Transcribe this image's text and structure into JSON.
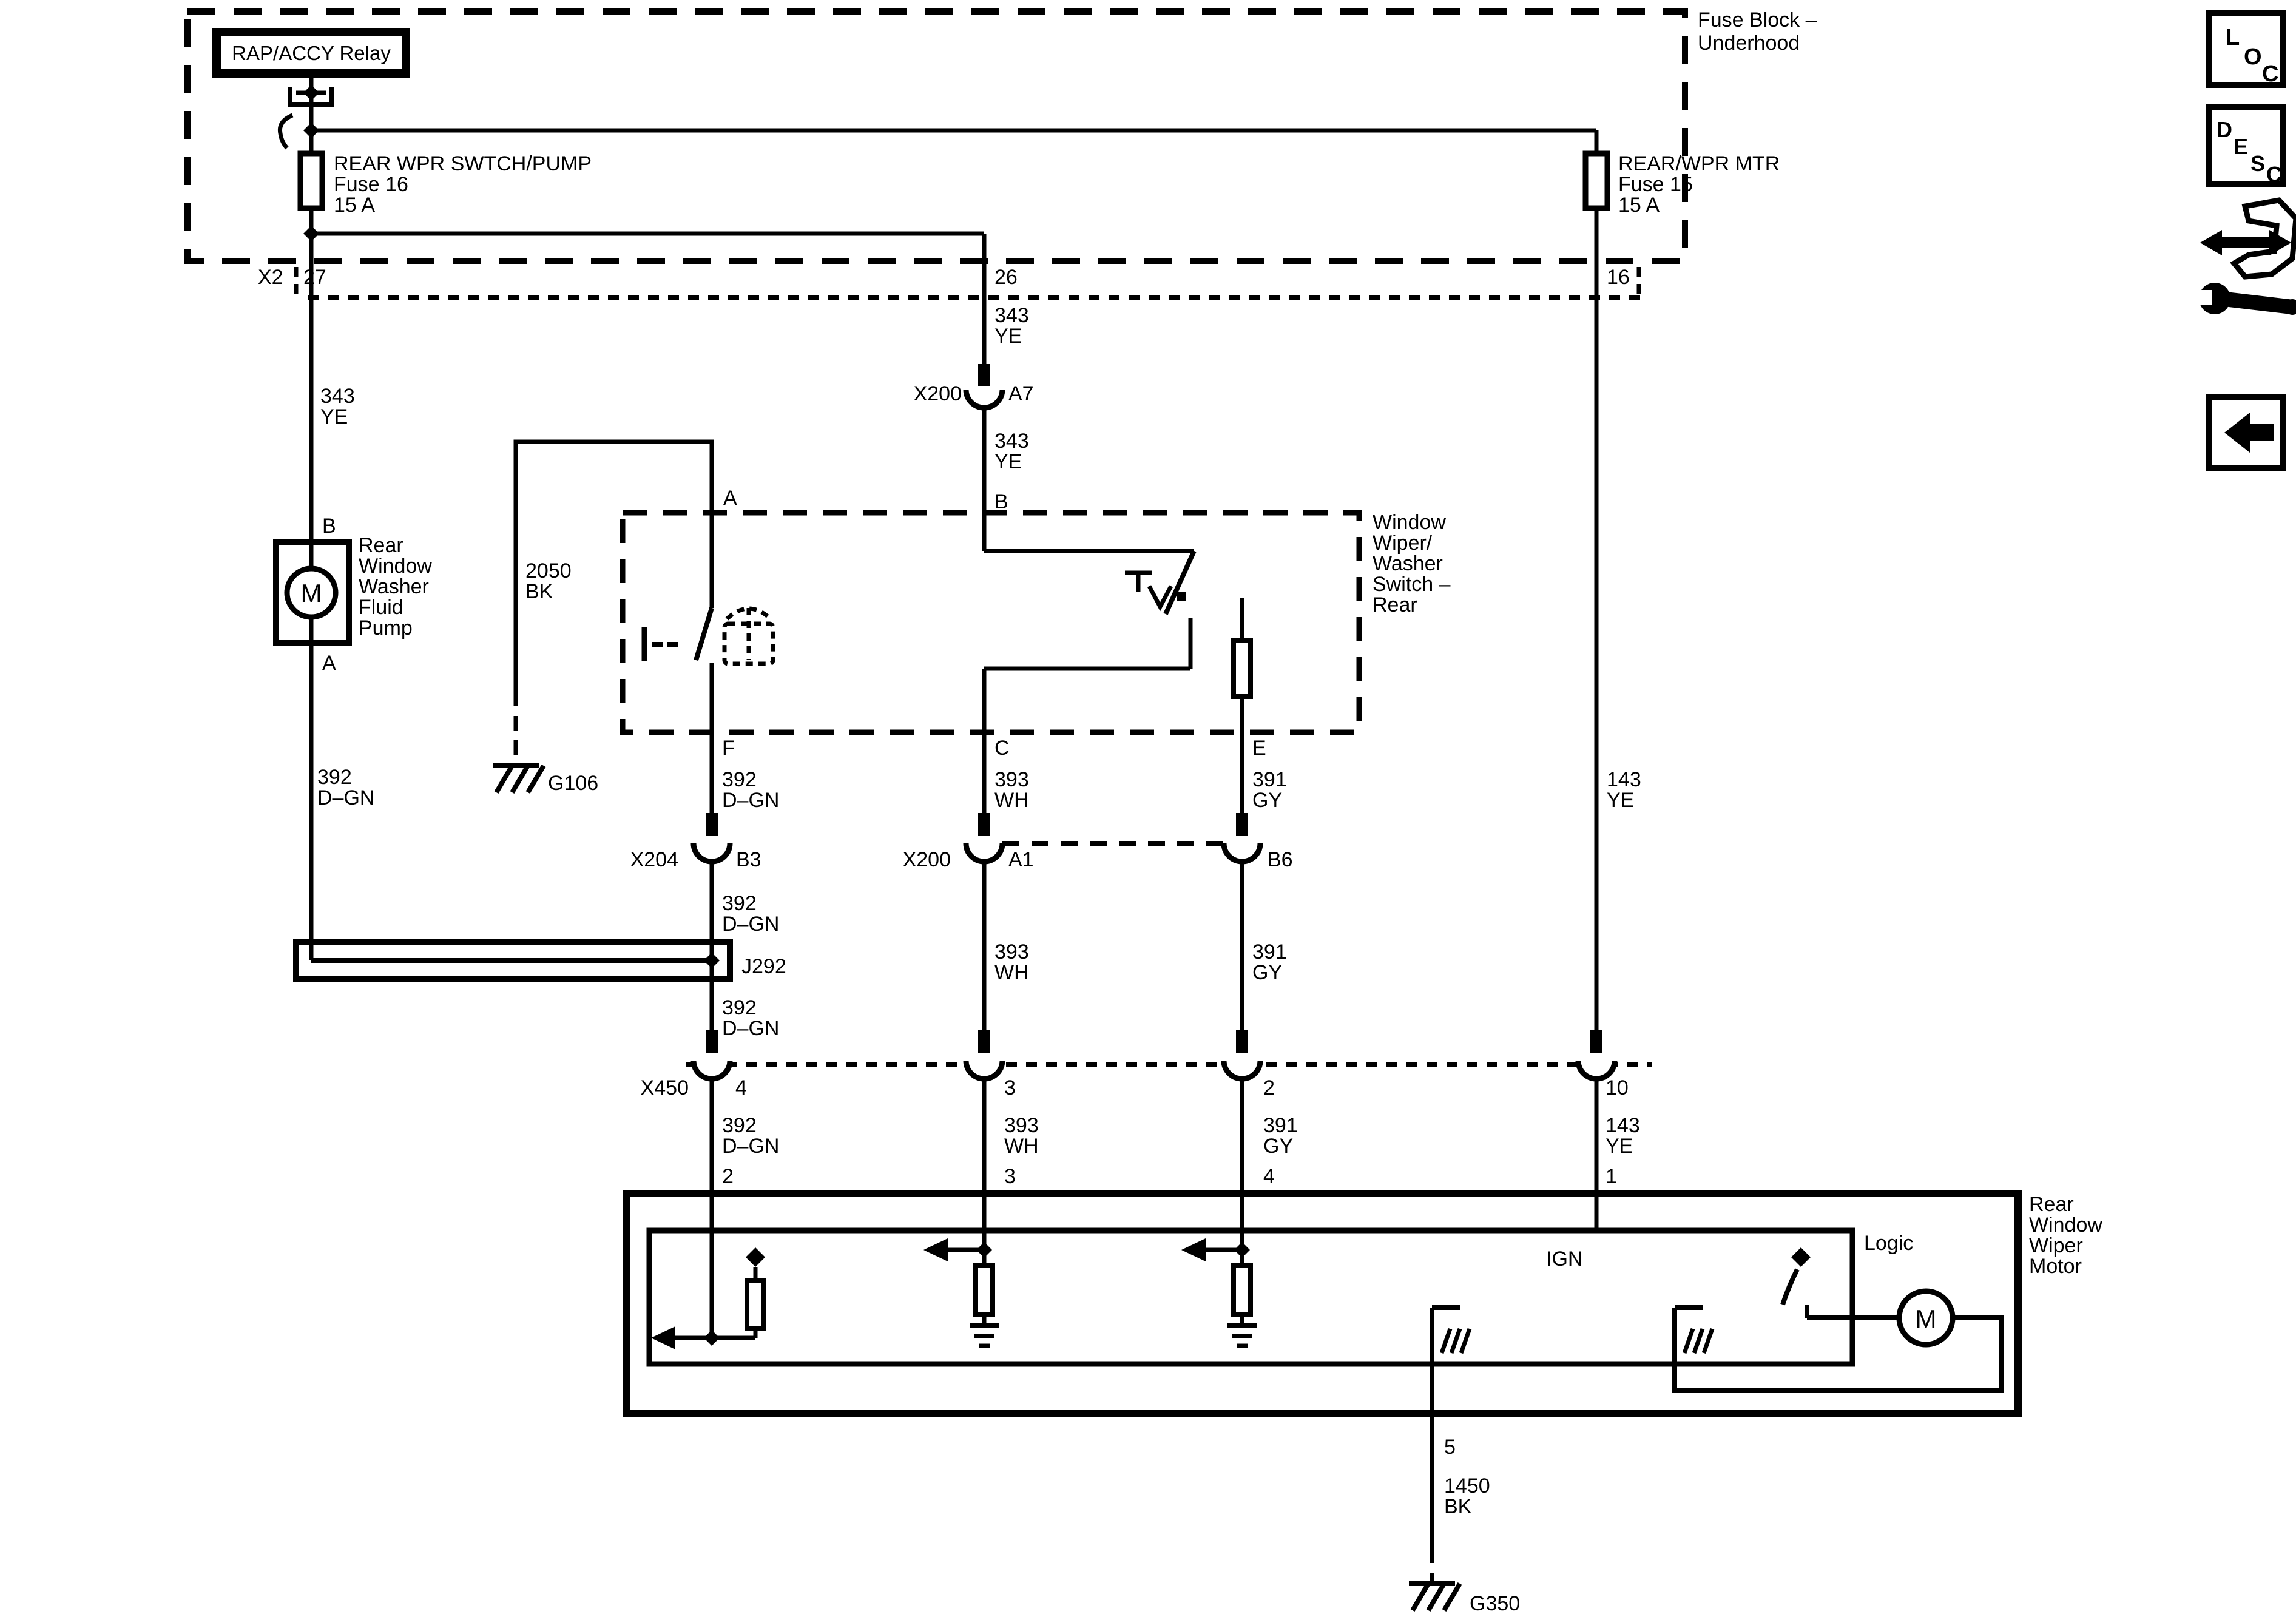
{
  "colors": {
    "ink": "#000000",
    "paper": "#ffffff"
  },
  "icons": [
    "loc-box-icon",
    "desc-box-icon",
    "pan-wrench-icon",
    "back-arrow-icon",
    "ground-chassis-icon",
    "motor-icon",
    "fuse-icon",
    "connector-icon"
  ],
  "t": {
    "relay": "RAP/ACCY Relay",
    "fuse_block_l1": "Fuse Block –",
    "fuse_block_l2": "Underhood",
    "fuse16_l1": "REAR WPR SWTCH/PUMP",
    "fuse16_l2": "Fuse 16",
    "fuse16_l3": "15 A",
    "fuse15_l1": "REAR/WPR MTR",
    "fuse15_l2": "Fuse 15",
    "fuse15_l3": "15 A",
    "x2": "X2",
    "pin27": "27",
    "pin26": "26",
    "pin16": "16",
    "left343": "343",
    "left343c": "YE",
    "mid343a": "343",
    "mid343ac": "YE",
    "x200a": "X200",
    "pinA7": "A7",
    "mid343b": "343",
    "mid343bc": "YE",
    "pinB_switch": "B",
    "pinA_switch": "A",
    "pinB_pump": "B",
    "pinA_pump": "A",
    "pump_l1": "Rear",
    "pump_l2": "Window",
    "pump_l3": "Washer",
    "pump_l4": "Fluid",
    "pump_l5": "Pump",
    "pump_m": "M",
    "c2050": "2050",
    "c2050c": "BK",
    "g106": "G106",
    "sw_l1": "Window",
    "sw_l2": "Wiper/",
    "sw_l3": "Washer",
    "sw_l4": "Switch –",
    "sw_l5": "Rear",
    "pinF": "F",
    "pinC": "C",
    "pinE": "E",
    "left392": "392",
    "left392c": "D–GN",
    "f392a": "392",
    "f392ac": "D–GN",
    "c393a": "393",
    "c393ac": "WH",
    "e391a": "391",
    "e391ac": "GY",
    "r143a": "143",
    "r143ac": "YE",
    "x204": "X204",
    "pinB3": "B3",
    "x200b": "X200",
    "pinA1": "A1",
    "pinB6": "B6",
    "f392b": "392",
    "f392bc": "D–GN",
    "c393b": "393",
    "c393bc": "WH",
    "e391b": "391",
    "e391bc": "GY",
    "j292": "J292",
    "f392c": "392",
    "f392cc": "D–GN",
    "x450": "X450",
    "x450p4": "4",
    "x450p3": "3",
    "x450p2": "2",
    "x450p10": "10",
    "f392d": "392",
    "f392dc": "D–GN",
    "c393c": "393",
    "c393cc": "WH",
    "e391c": "391",
    "e391cc": "GY",
    "r143b": "143",
    "r143bc": "YE",
    "mpin2": "2",
    "mpin3": "3",
    "mpin4": "4",
    "mpin1": "1",
    "ign": "IGN",
    "logic": "Logic",
    "motor_l1": "Rear",
    "motor_l2": "Window",
    "motor_l3": "Wiper",
    "motor_l4": "Motor",
    "motor_m": "M",
    "mpin5": "5",
    "c1450": "1450",
    "c1450c": "BK",
    "g350": "G350",
    "loc1": "L",
    "loc2": "O",
    "loc3": "C",
    "desc1": "D",
    "desc2": "E",
    "desc3": "S",
    "desc4": "C"
  }
}
